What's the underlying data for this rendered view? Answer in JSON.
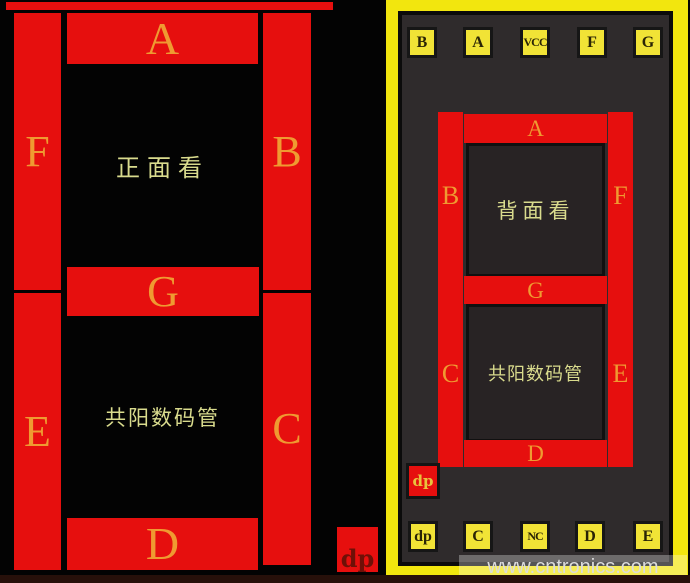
{
  "front_view": {
    "title": "正面看",
    "type_label": "共阳数码管",
    "segments": {
      "a": "A",
      "b": "B",
      "c": "C",
      "d": "D",
      "e": "E",
      "f": "F",
      "g": "G"
    },
    "dp_label": "dp"
  },
  "back_view": {
    "title": "背面看",
    "type_label": "共阳数码管",
    "segments": {
      "a": "A",
      "b": "B",
      "c": "C",
      "d": "D",
      "e": "E",
      "f": "F",
      "g": "G"
    },
    "dp_label": "dp",
    "top_pins": [
      "B",
      "A",
      "VCC",
      "F",
      "G"
    ],
    "bottom_pins": [
      "dp",
      "C",
      "NC",
      "D",
      "E"
    ]
  },
  "watermark": "www.cntronics.com",
  "colors": {
    "segment_red": "#e60f0e",
    "board_yellow": "#f2e60e",
    "pin_yellow": "#f1e336",
    "segment_letter_gold": "#ef9a31",
    "cjk_text_green": "#d9db8d",
    "panel_gray": "#2f2b2c",
    "background_black": "#030303"
  }
}
